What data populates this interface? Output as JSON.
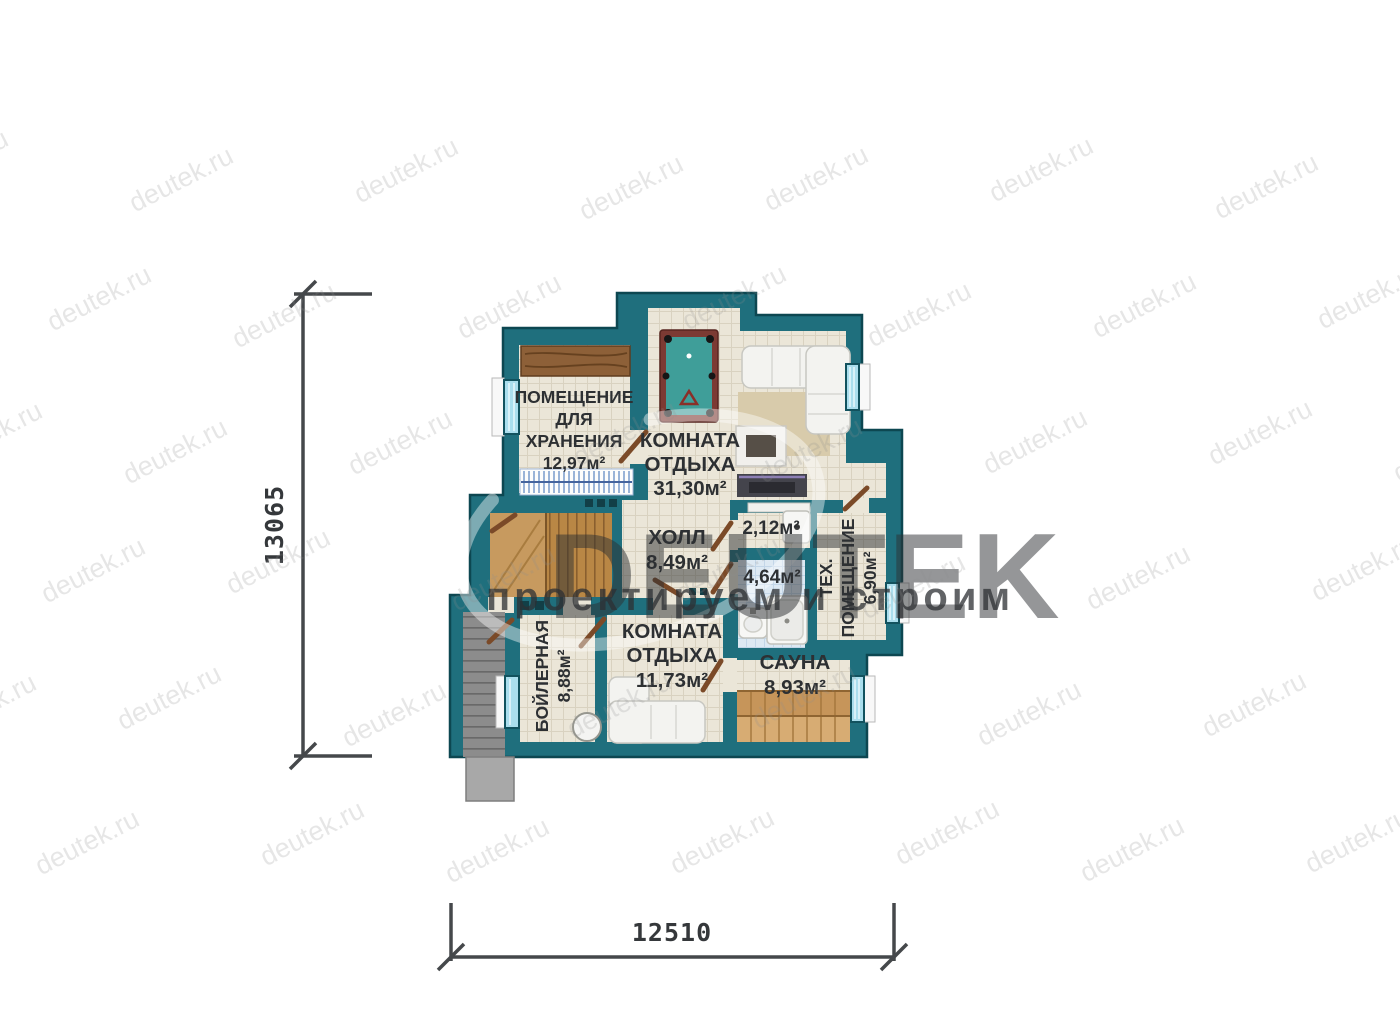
{
  "plan": {
    "rooms": {
      "storage": {
        "name_lines": [
          "ПОМЕЩЕНИЕ",
          "ДЛЯ",
          "ХРАНЕНИЯ"
        ],
        "area": "12,97м²"
      },
      "rest1": {
        "name_lines": [
          "КОМНАТА",
          "ОТДЫХА"
        ],
        "area": "31,30м²"
      },
      "hall": {
        "name": "ХОЛЛ",
        "area": "8,49м²"
      },
      "wc": {
        "area": "2,12м²"
      },
      "bath": {
        "area": "4,64м²"
      },
      "tech": {
        "name_lines": [
          "ТЕХ.",
          "ПОМЕЩЕНИЕ"
        ],
        "area": "6,90м²"
      },
      "boiler": {
        "name": "БОЙЛЕРНАЯ",
        "area": "8,88м²"
      },
      "rest2": {
        "name_lines": [
          "КОМНАТА",
          "ОТДЫХА"
        ],
        "area": "11,73м²"
      },
      "sauna": {
        "name": "САУНА",
        "area": "8,93м²"
      }
    },
    "dimensions": {
      "vertical": "13065",
      "horizontal": "12510"
    },
    "colors": {
      "wall": "#1f6f7d",
      "floor": "#ebe6d8",
      "bath_floor": "#dde9f3",
      "accent_wood": "#c79a5f",
      "pool_felt": "#3f9e99",
      "door": "#7b4a28"
    }
  },
  "watermark": {
    "tile_text": "deutek.ru",
    "logo_text": "DEUTEK",
    "slogan": "проектируем и строим"
  }
}
